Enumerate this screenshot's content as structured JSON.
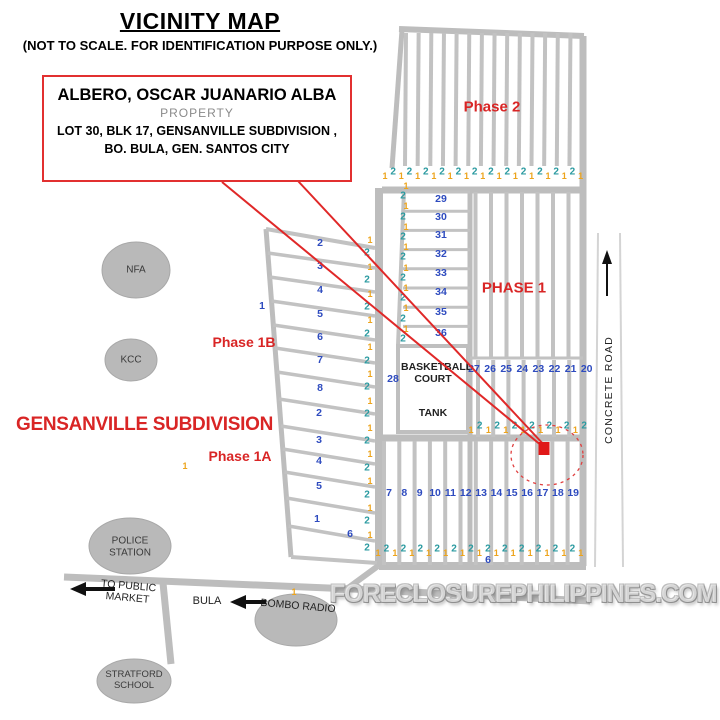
{
  "title": "VICINITY MAP",
  "subtitle": "(NOT TO SCALE. FOR IDENTIFICATION PURPOSE ONLY.)",
  "callout": {
    "owner": "ALBERO, OSCAR JUANARIO ALBA",
    "property_label": "PROPERTY",
    "address_line1": "LOT 30, BLK 17, GENSANVILLE SUBDIVISION ,",
    "address_line2": "BO. BULA,  GEN. SANTOS CITY"
  },
  "labels": {
    "subdivision": "GENSANVILLE SUBDIVISION",
    "phase2": "Phase 2",
    "phase1": "PHASE 1",
    "phase1b": "Phase 1B",
    "phase1a": "Phase 1A",
    "basketball_court": "BASKETBALL COURT",
    "tank": "TANK",
    "concrete_road": "CONCRETE ROAD",
    "bula": "BULA",
    "to_public_market": "TO PUBLIC MARKET",
    "bombo_radio": "BOMBO RADIO",
    "watermark": "FORECLOSUREPHILIPPINES.COM"
  },
  "landmarks": [
    "NFA",
    "KCC",
    "POLICE STATION",
    "STRATFORD SCHOOL"
  ],
  "blocks": {
    "mid_rows": [
      "29",
      "30",
      "31",
      "32",
      "33",
      "34",
      "35",
      "36"
    ],
    "upper_right_row": [
      "27",
      "26",
      "25",
      "24",
      "23",
      "22",
      "21",
      "20"
    ],
    "bottom_row": [
      "7",
      "8",
      "9",
      "10",
      "11",
      "12",
      "13",
      "14",
      "15",
      "16",
      "17",
      "18",
      "19"
    ],
    "phase1b_rows": [
      "2",
      "3",
      "4",
      "5",
      "6",
      "7",
      "8"
    ],
    "phase1a_rows": [
      "2",
      "3",
      "4",
      "5"
    ],
    "bottom_left_rows": [
      "1",
      "6"
    ],
    "bottom_center": "6",
    "block_28": "28",
    "left_strip": "1"
  },
  "lot_sequences": {
    "pattern": [
      "1",
      "2"
    ],
    "phase2_row_count": 25,
    "mid_row_count": 14,
    "bottom_row_count": 25,
    "left_column_count": 24,
    "mid_column_count": 16,
    "singles": [
      "1",
      "1"
    ]
  },
  "colors": {
    "accent_red": "#e02828",
    "block_blue": "#2e4bbf",
    "marker_orange": "#eda41c",
    "marker_teal": "#2a9aa0",
    "road_gray": "#c2c2c2"
  }
}
